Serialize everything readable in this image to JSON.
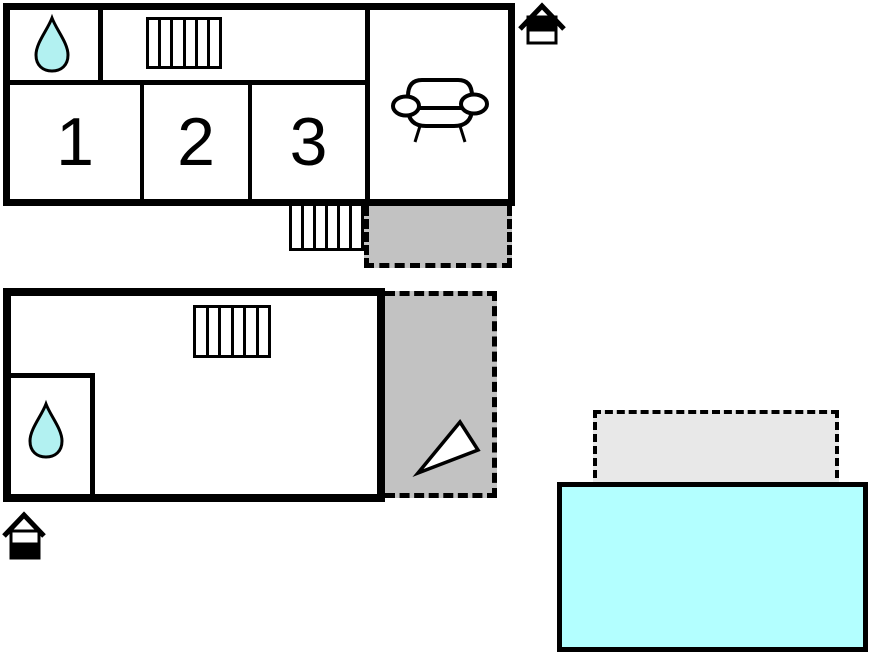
{
  "canvas": {
    "background": "#ffffff",
    "width": 870,
    "height": 652
  },
  "colors": {
    "outline": "#000000",
    "water_drop": "#b2f1f1",
    "pool": "#b3ffff",
    "terrace": "#c2c2c2",
    "patio": "#e8e8e8"
  },
  "upper_floor": {
    "room_labels": [
      "1",
      "2",
      "3"
    ],
    "icons": {
      "bathroom": "water-drop-icon",
      "stairs_inside": "stairs-icon",
      "stairs_outside": "exterior-stairs-icon",
      "living_room": "sofa-icon",
      "level_indicator": "house-upper-level-icon"
    }
  },
  "ground_floor": {
    "icons": {
      "bathroom": "water-drop-icon",
      "stairs_inside": "stairs-icon",
      "direction": "north-arrow-icon",
      "level_indicator": "house-ground-level-icon"
    }
  },
  "outdoor": {
    "features": [
      "terrace-upper",
      "terrace-ground",
      "patio",
      "swimming-pool"
    ]
  }
}
